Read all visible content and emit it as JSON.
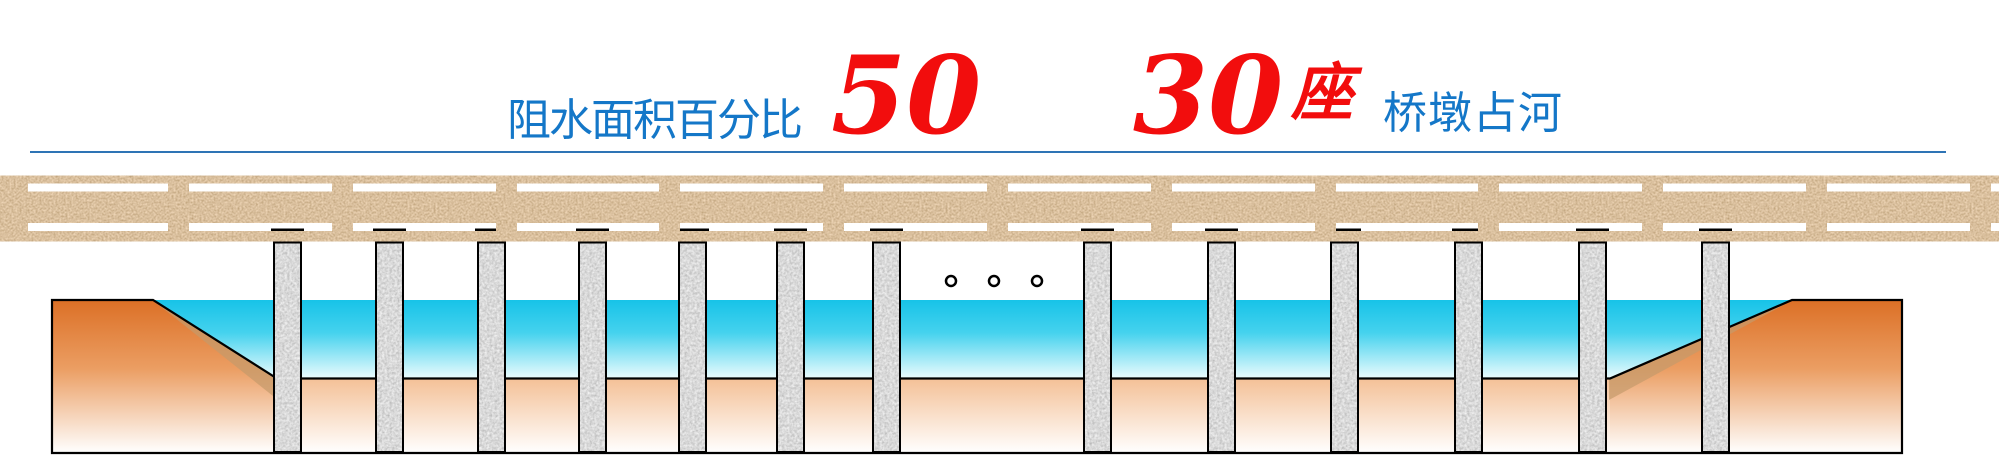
{
  "title": {
    "left_label": "阻水面积百分比",
    "percent_value": "50",
    "count_value": "30",
    "count_unit": "座",
    "right_label": "桥墩占河"
  },
  "colors": {
    "label_blue": "#1477C8",
    "number_red": "#F20D0D",
    "rule_blue": "#2E74B5",
    "water_top": "#17C3E8",
    "water_bottom": "#EAFBFD",
    "bank_orange": "#DC7026",
    "bed_peach": "#F4C096",
    "deck_sand": "#C1895A",
    "pier_granite": "#C8C8C8",
    "outline_black": "#000000"
  },
  "scene": {
    "visible_pier_count": 13,
    "pier_xs_left": [
      273,
      375,
      477,
      578,
      678,
      776,
      872
    ],
    "pier_xs_right": [
      1083,
      1207,
      1330,
      1454,
      1578,
      1701
    ],
    "pier_width": 29,
    "pier_top_y": 241.5,
    "pier_bottom_y": 453,
    "cap_y": 228.5,
    "cap_height": 4,
    "dots_x": [
      951,
      994,
      1037
    ],
    "dots_y": 281,
    "dot_radius": 5,
    "post_start": 168,
    "post_pitch": 163.8,
    "post_count": 12,
    "post_width": 21,
    "post_top": 183.5,
    "post_height": 47.5
  }
}
